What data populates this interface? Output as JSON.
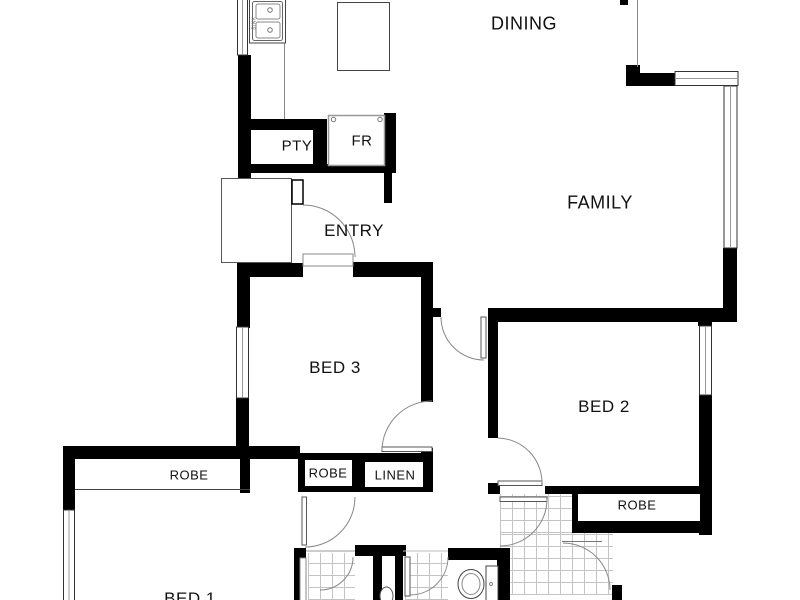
{
  "title": "Floor plan",
  "rooms": {
    "dining": {
      "label": "DINING"
    },
    "family": {
      "label": "FAMILY"
    },
    "entry": {
      "label": "ENTRY"
    },
    "pantry": {
      "label": "PTY"
    },
    "fridge": {
      "label": "FR"
    },
    "bed3": {
      "label": "BED 3"
    },
    "bed2": {
      "label": "BED 2"
    },
    "bed1": {
      "label": "BED 1"
    },
    "robe_bed1": {
      "label": "ROBE"
    },
    "robe_hall": {
      "label": "ROBE"
    },
    "robe_bed2": {
      "label": "ROBE"
    },
    "linen": {
      "label": "LINEN"
    }
  },
  "fixtures": {
    "sink_label": "SINK"
  },
  "colors": {
    "wall": "#000000",
    "thin_line": "#555555",
    "door_arc": "#888888",
    "tile_line": "#c4c4c4",
    "background": "#ffffff"
  }
}
